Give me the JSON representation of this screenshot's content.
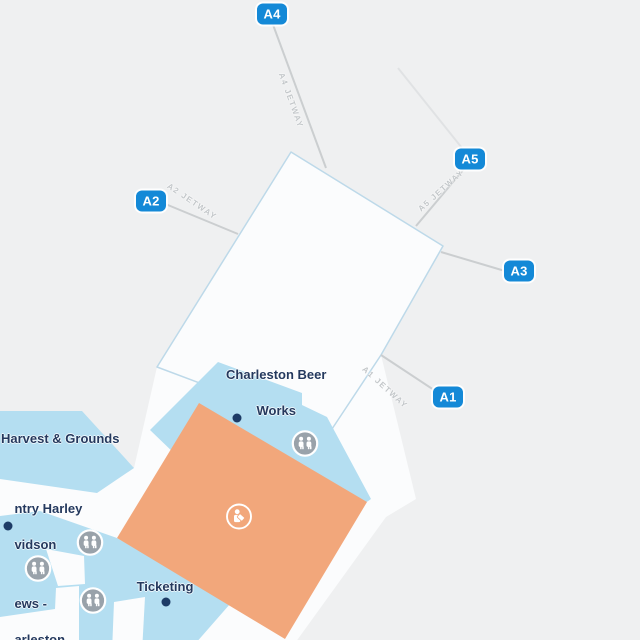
{
  "map": {
    "title": "Charleston Airport Concourse A map",
    "colors": {
      "background": "#eff0f1",
      "terminal_fill": "#fbfcfd",
      "terminal_border": "#bdd9e9",
      "area_blue": "#b4def1",
      "area_orange": "#f2a77b",
      "gate_badge": "#1489d7",
      "label_navy": "#24395e",
      "jetway_line": "#cbced0",
      "jetway_text": "#c2c6c9",
      "restroom_gray": "#99a2aa"
    }
  },
  "gates": [
    {
      "id": "A1"
    },
    {
      "id": "A2"
    },
    {
      "id": "A3"
    },
    {
      "id": "A4"
    },
    {
      "id": "A5"
    }
  ],
  "jetways": [
    {
      "label": "A4 JETWAY"
    },
    {
      "label": "A2 JETWAY"
    },
    {
      "label": "A5 JETWAY"
    },
    {
      "label": "A1 JETWAY"
    }
  ],
  "places": {
    "beer_works": {
      "line1": "Charleston Beer",
      "line2": "Works"
    },
    "harvest": {
      "label": "Harvest & Grounds"
    },
    "harley": {
      "line1": "ntry Harley",
      "line2": "vidson"
    },
    "news": {
      "line1": "ews -",
      "line2": "arleston"
    },
    "ticketing": {
      "label": "Ticketing"
    }
  },
  "icons": {
    "restroom": "restroom-icon",
    "ticket_counter": "ticket-counter-icon"
  }
}
